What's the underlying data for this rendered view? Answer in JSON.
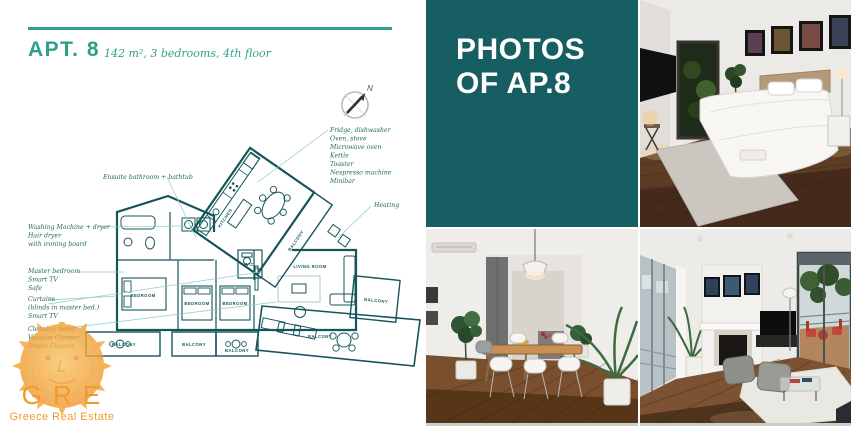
{
  "colors": {
    "accent_teal": "#2f9f8a",
    "panel_teal": "#175e62",
    "plan_line": "#14555a",
    "annotation_teal": "#20695e",
    "leader_teal": "#8ccbbb",
    "logo_orange": "#ef9b2e"
  },
  "header": {
    "title": "APT. 8",
    "subtitle": "142 m², 3 bedrooms, 4th floor"
  },
  "photos_panel": {
    "line1": "PHOTOS",
    "line2": "OF AP.8"
  },
  "compass": {
    "north_label": "N"
  },
  "plan": {
    "bedrooms": [
      "BEDROOM",
      "BEDROOM",
      "BEDROOM"
    ],
    "balconies": [
      "BALCONY",
      "BALCONY",
      "BALCONY",
      "BALCONY",
      "BALCONY",
      "BALCONY"
    ],
    "living_room": "LIVING ROOM",
    "kitchen": "KITCHEN",
    "wc": "W.C.",
    "annotations": {
      "appliances": [
        "Fridge, dishwasher",
        "Oven, stove",
        "Microwave oven",
        "Kettle",
        "Toaster",
        "Nespresso machine",
        "Minibar"
      ],
      "ensuite": "Ensuite bathroom + bathtub",
      "laundry": [
        "Washing Machine + dryer",
        "Hair dryer",
        "with ironing board"
      ],
      "master": [
        "Master bedroom",
        "Smart TV",
        "Safe"
      ],
      "curtains": [
        "Curtains",
        "(blinds in master bed.)",
        "Smart TV"
      ],
      "cleaning": [
        "Cleaning items",
        "Vacuum Cleaner",
        "Steam Cleaner"
      ],
      "heating": "Heating"
    }
  },
  "logo": {
    "acronym": "G R E",
    "name": "Greece Real Estate"
  }
}
